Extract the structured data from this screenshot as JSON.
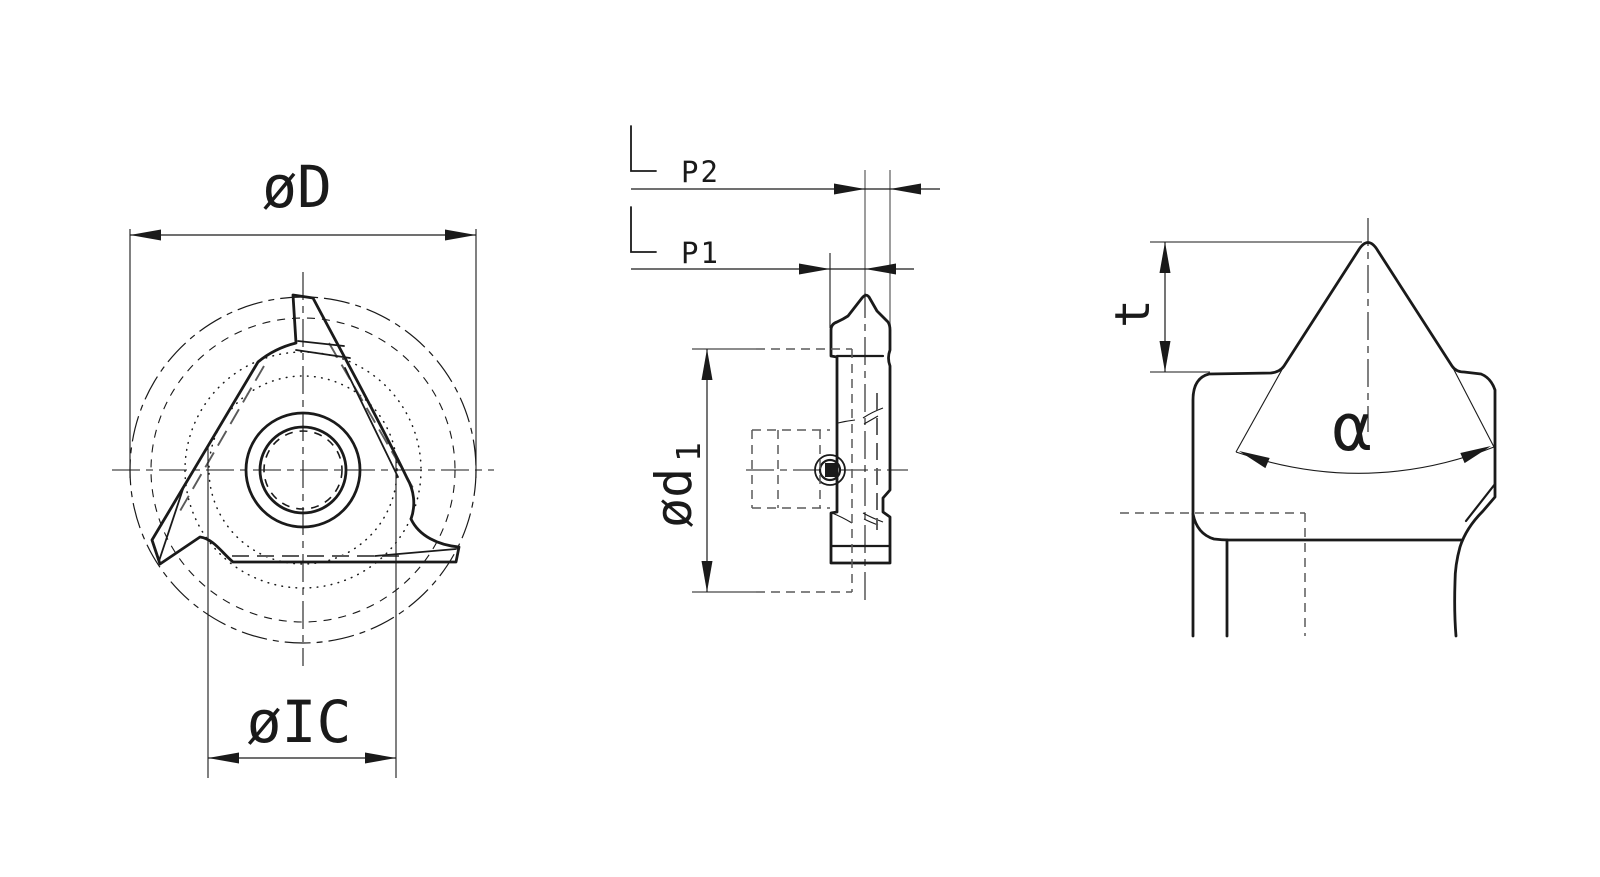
{
  "drawing": {
    "type": "engineering-drawing",
    "subject": "triangular threading insert, three orthographic views",
    "background": "#ffffff",
    "line_color": "#1a1a1a",
    "hidden_line_color": "#5a5a5a",
    "gauge_line_color": "#8c8c8c",
    "views": {
      "front_view": {
        "label": "front view",
        "dim_outer_diameter": "øD",
        "dim_inscribed_circle": "øIC"
      },
      "side_view": {
        "label": "side view",
        "dim_p2": "P2",
        "dim_p1": "P1",
        "dim_bore_main": "ød",
        "dim_bore_sub": "1"
      },
      "tip_detail_view": {
        "label": "cutting tip detail",
        "dim_tip_height": "t",
        "dim_tip_angle": "α"
      }
    }
  }
}
